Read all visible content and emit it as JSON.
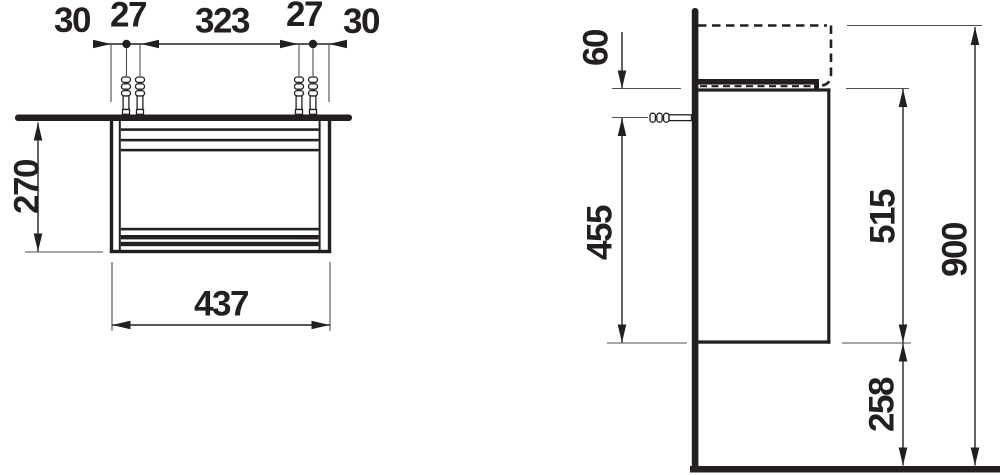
{
  "colors": {
    "background": "#ffffff",
    "ink": "#231f20",
    "extension_line": "#4f4f4f"
  },
  "front_view": {
    "top_chain": [
      "30",
      "27",
      "323",
      "27",
      "30"
    ],
    "side_height": "270",
    "total_width": "437"
  },
  "side_view": {
    "top_to_fixing": "60",
    "fixing_to_bottom": "455",
    "cabinet_height": "515",
    "total_height": "900",
    "floor_clearance": "258"
  },
  "icons": {
    "wall_plug": "wall-plug-icon",
    "dimension_arrow": "arrowhead-icon",
    "fixing_point": "dim-point-dot"
  }
}
